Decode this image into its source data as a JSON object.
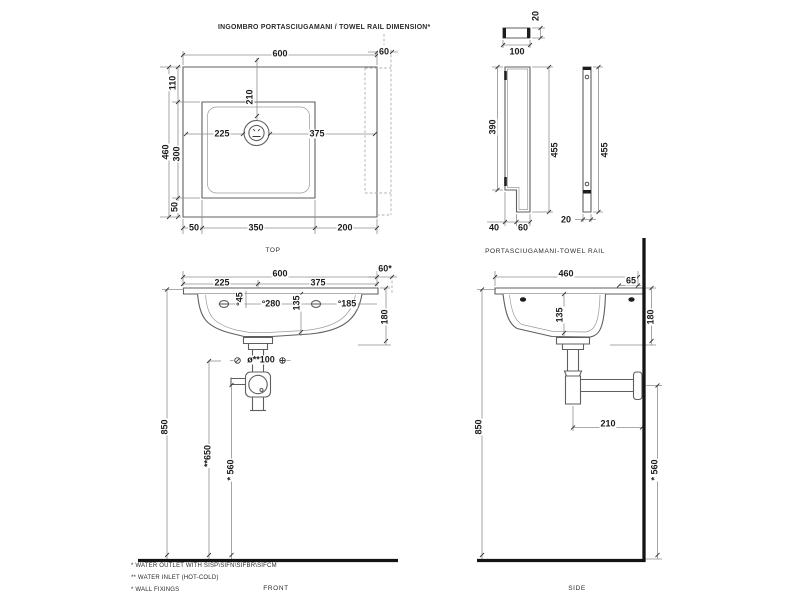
{
  "title": "INGOMBRO PORTASCIUGAMANI / TOWEL RAIL DIMENSION*",
  "views": {
    "top": {
      "label": "TOP",
      "dims": {
        "width": "600",
        "rail": "60",
        "back_offset": "110",
        "depth": "460",
        "basin_depth": "300",
        "front_offset": "50",
        "left_margin": "50",
        "basin_width": "350",
        "right_margin": "200",
        "tap_left": "225",
        "tap_back": "210",
        "tap_right": "375"
      }
    },
    "rail_front": {
      "label": "PORTASCIUGAMANI-TOWEL RAIL",
      "dims": {
        "thickness": "20",
        "width": "100",
        "face_height": "390",
        "height": "455",
        "foot_left": "40",
        "foot_right": "60"
      }
    },
    "rail_side": {
      "dims": {
        "height": "455",
        "thickness": "20"
      }
    },
    "front": {
      "label": "FRONT",
      "dims": {
        "width": "600",
        "tap_left": "225",
        "tap_right": "375",
        "rail": "60*",
        "tap_hole": "°45",
        "inlet_span": "°280",
        "bowl_depth": "135",
        "inlet_side": "°185",
        "edge_height": "180",
        "drain": "ø**100",
        "rim_height": "850",
        "inlet_height": "**650",
        "outlet_height": "* 560"
      }
    },
    "side": {
      "label": "SIDE",
      "dims": {
        "depth": "460",
        "wall_offset": "65",
        "bowl_depth": "135",
        "edge_height": "180",
        "trap_offset": "210",
        "rim_height": "850",
        "outlet_height": "* 560"
      }
    }
  },
  "footnotes": [
    "* WATER OUTLET WITH SISP\\SIFN\\SIFBR\\SIFCM",
    "** WATER INLET  (HOT-COLD)",
    "* WALL FIXINGS"
  ],
  "colors": {
    "background": "#ffffff",
    "line": "#5f5f5f",
    "dim_line": "#8f8f8f",
    "heavy_line": "#141414",
    "text": "#1c1c1c"
  }
}
